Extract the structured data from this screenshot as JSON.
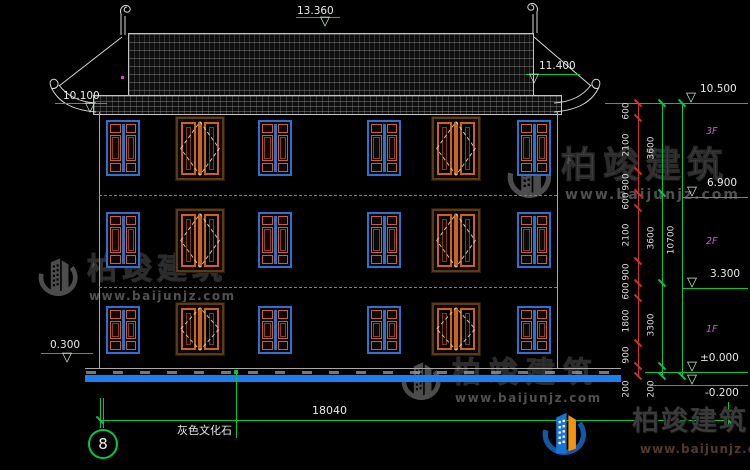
{
  "brand": {
    "name": "柏竣建筑",
    "site": "www.baijunjz.com"
  },
  "dims": {
    "ridge": "13.360",
    "eave_right": "11.400",
    "eave_left": "10.100",
    "top_right": "10.500",
    "floor3": "6.900",
    "floor2": "3.300",
    "ground": "±0.000",
    "foundation": "-0.200",
    "plinth": "0.300",
    "total_width": "18040"
  },
  "chain": {
    "segments": [
      "600",
      "2100",
      "900",
      "600",
      "2100",
      "900",
      "600",
      "1800",
      "900",
      "200"
    ],
    "subtotals": [
      "3600",
      "3600",
      "3300",
      "200"
    ],
    "overall": "10700"
  },
  "floors": [
    "3F",
    "2F",
    "1F"
  ],
  "notes": {
    "material": "灰色文化石",
    "axis": "8"
  },
  "facade": {
    "columns_x": [
      106,
      176,
      258,
      367,
      432,
      517
    ],
    "column_types": [
      "A",
      "B",
      "A",
      "A",
      "B",
      "A"
    ],
    "rows": [
      {
        "y_a": 120,
        "h_a": 56,
        "y_b": 117,
        "h_b": 63
      },
      {
        "y_a": 212,
        "h_a": 56,
        "y_b": 209,
        "h_b": 63
      },
      {
        "y_a": 306,
        "h_a": 48,
        "y_b": 303,
        "h_b": 52
      }
    ]
  },
  "colors": {
    "dimension_green": "#00c846",
    "chain_red": "#d03030",
    "ground_blue": "#1d7ef0",
    "frame_blue": "#2e6fd0",
    "frame_orange": "#c8641e",
    "floor_label_magenta": "#c560c5"
  }
}
